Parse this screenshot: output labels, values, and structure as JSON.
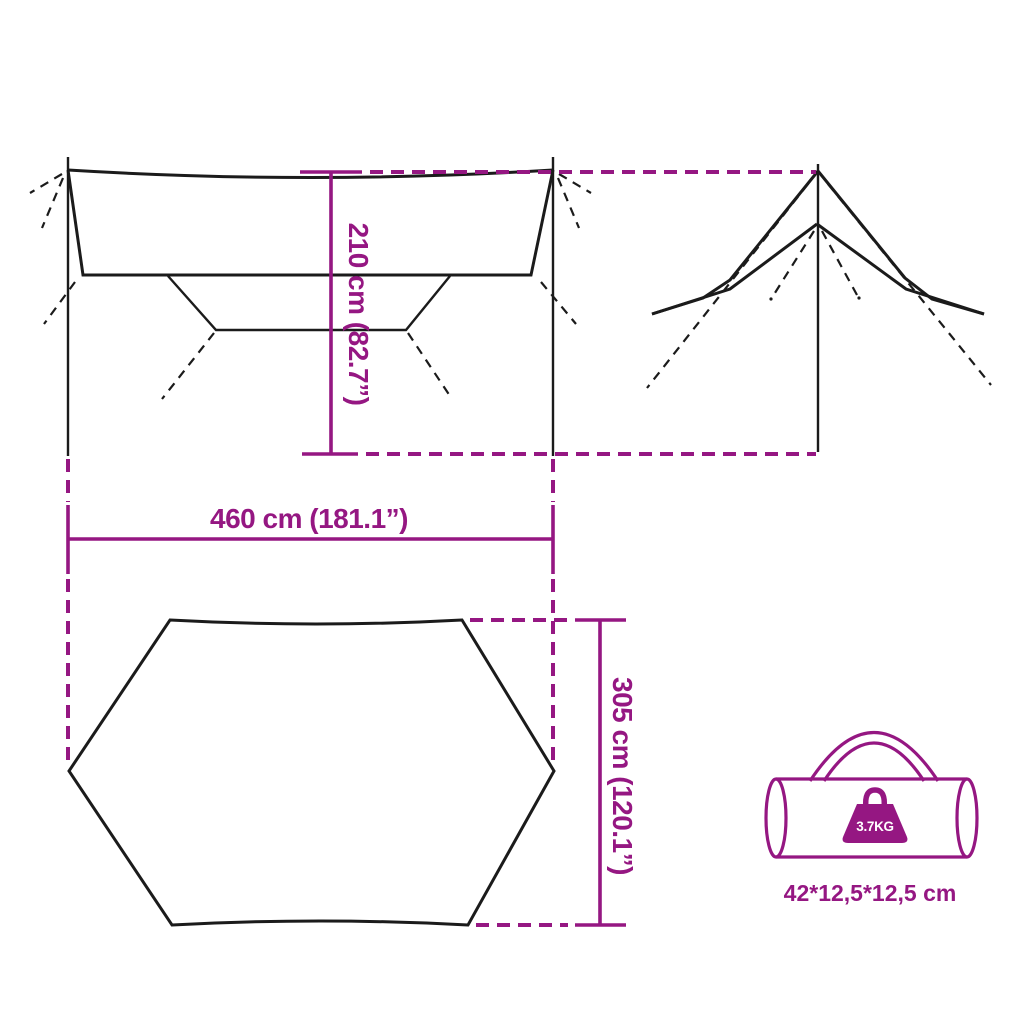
{
  "colors": {
    "magenta": "#951782",
    "line_black": "#1b1b1b",
    "white": "#ffffff",
    "background": "#ffffff"
  },
  "dimension_labels": {
    "height": "210 cm (82.7”)",
    "width": "460 cm (181.1”)",
    "depth": "305 cm (120.1”)"
  },
  "bag": {
    "weight": "3.7KG",
    "size": "42*12,5*12,5 cm"
  },
  "icons": {
    "front_view": "tarp-front-view-drawing",
    "side_view": "tarp-side-view-drawing",
    "top_view": "tarp-top-view-hexagon",
    "bag": "carry-bag-icon",
    "weight": "weight-icon"
  }
}
